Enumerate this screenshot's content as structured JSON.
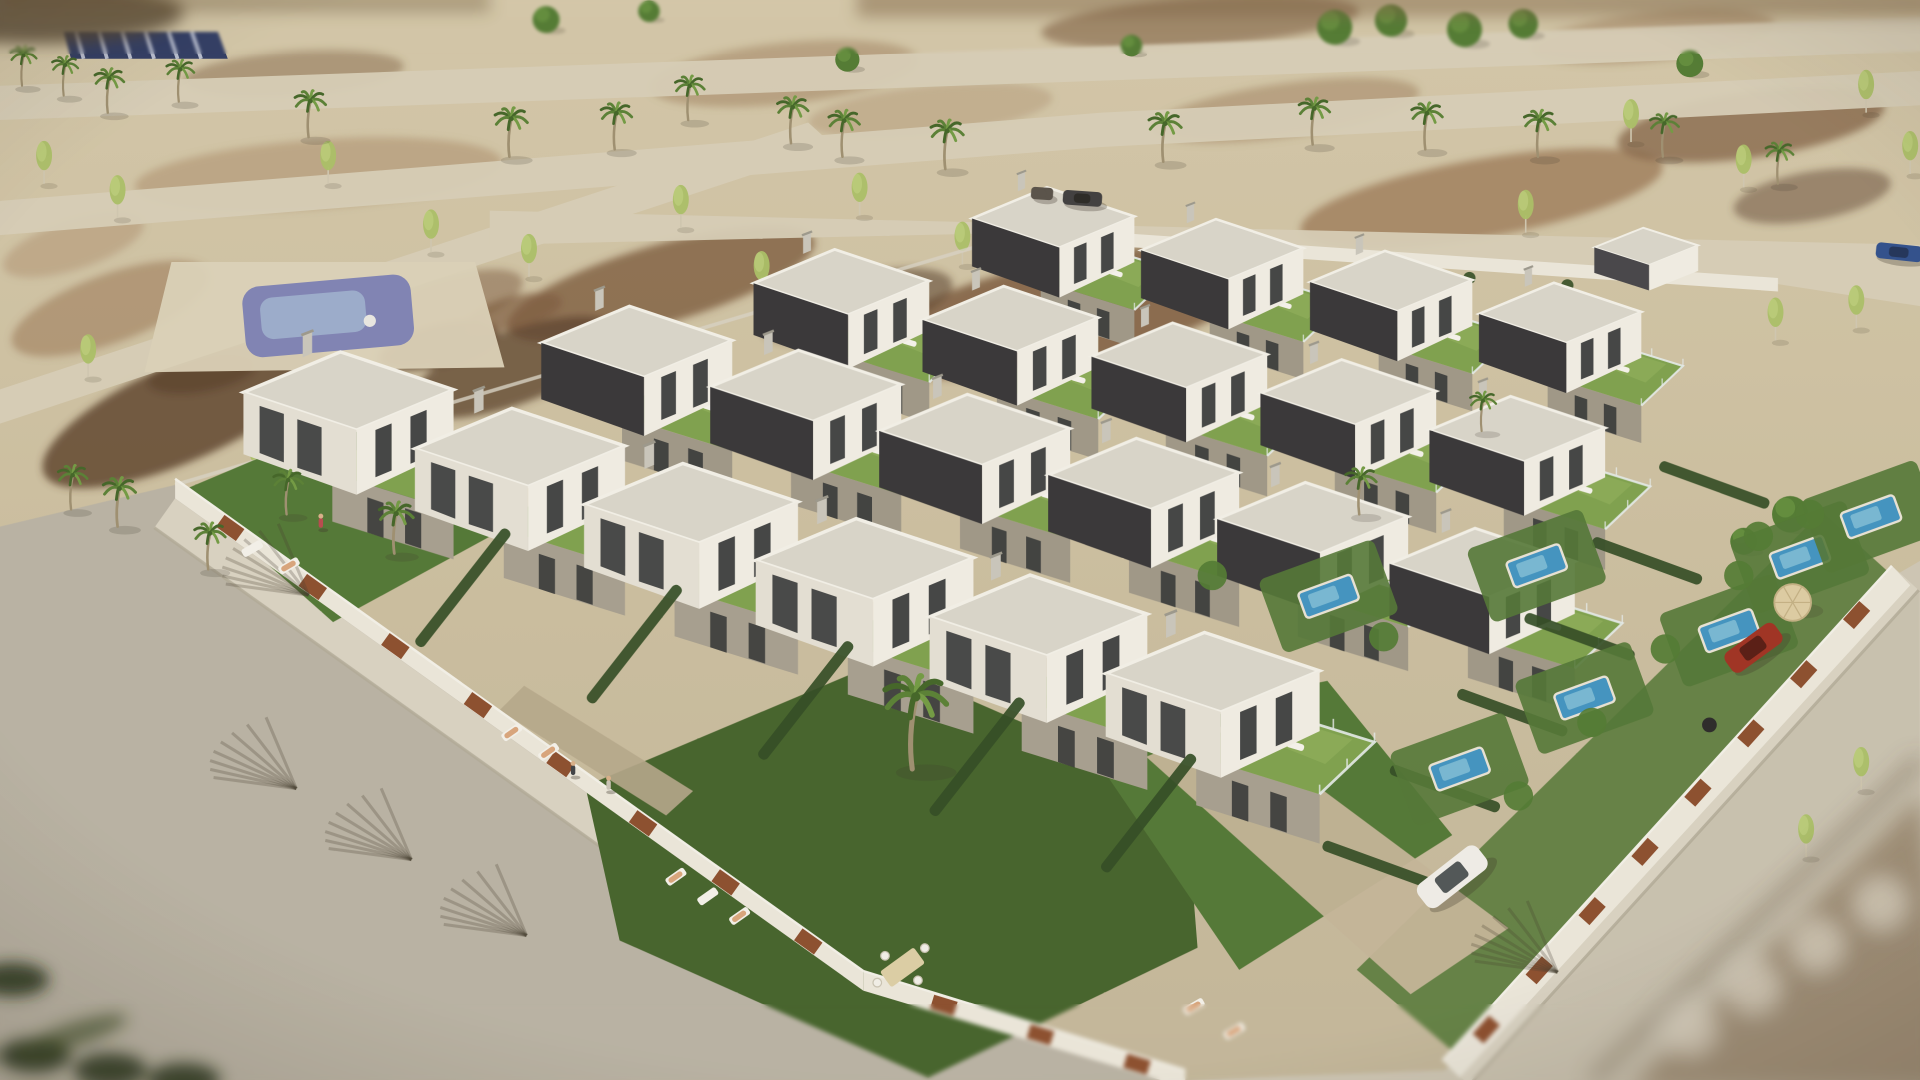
{
  "scene": {
    "name": "aerial-3d-render-modern-villa-development",
    "width": 1568,
    "height": 882
  },
  "palette": {
    "sandTop": "#d3c8ac",
    "sandMid": "#cbbfa3",
    "sandBot": "#c2b79d",
    "road": "#d6cfbb",
    "streetSW": "#b8b3a7",
    "streetSE": "#cdc7b8",
    "sidewalk": "#d8d3c6",
    "curb": "#b0aa9a",
    "dirt1": "#9b7b5b",
    "dirt2": "#7a5a40",
    "dirt3": "#5c4330",
    "dirt4": "#b2987a",
    "wall": "#ebe8df",
    "wallShade": "#d8d4c8",
    "rust": "#8a4c2e",
    "roofLight": "#d8d6ce",
    "roofFascia": "#f3f2ec",
    "darkWall": "#333338",
    "darkWall2": "#43434a",
    "white1": "#f1efe8",
    "white2": "#e4e1d8",
    "stone": "#a59f92",
    "window": "#2b2f33",
    "terrace": "#7ca14f",
    "terraceHi": "#8fb35e",
    "lawn": "#4f7636",
    "lawnDark": "#41612c",
    "hedge": "#2e4a24",
    "glass": "#e6edef",
    "poolWater": "#3e93c4",
    "poolLight": "#82c2dc",
    "parkPool": "#7d82b8",
    "parkPoolHi": "#a3bad8",
    "palmDark": "#3f6428",
    "palmMid": "#567f35",
    "palmLight": "#6f9a44",
    "trunk": "#9c8f72",
    "birch": "#a9c068",
    "birchHi": "#c6d889",
    "treeRound": "#4e7a33",
    "treeRoundHi": "#639140",
    "navy": "#2c3a66",
    "navyStripe": "#cfd6e8",
    "shadow": "#3a342a",
    "paving": "#c3b59b",
    "stonePath": "#b4a78d"
  },
  "terrain_patches": [
    [
      260,
      142,
      300,
      56,
      -4,
      "dirt4",
      0.7
    ],
    [
      540,
      232,
      260,
      64,
      -16,
      "dirt2",
      0.8
    ],
    [
      870,
      255,
      330,
      86,
      -12,
      "dirt2",
      0.85
    ],
    [
      1210,
      162,
      300,
      64,
      -10,
      "dirt1",
      0.8
    ],
    [
      1430,
      102,
      220,
      54,
      -8,
      "dirt2",
      0.7
    ],
    [
      90,
      252,
      170,
      56,
      -20,
      "dirt1",
      0.6
    ],
    [
      150,
      336,
      250,
      80,
      -24,
      "dirt3",
      0.85
    ],
    [
      420,
      300,
      180,
      60,
      -20,
      "dirt3",
      0.8
    ],
    [
      640,
      60,
      220,
      50,
      -6,
      "dirt1",
      0.5
    ],
    [
      980,
      18,
      260,
      40,
      -4,
      "dirt2",
      0.6
    ],
    [
      1350,
      30,
      200,
      40,
      -6,
      "dirt1",
      0.5
    ],
    [
      60,
      200,
      120,
      40,
      -18,
      "dirt4",
      0.6
    ],
    [
      360,
      250,
      140,
      44,
      -18,
      "dirt2",
      0.5
    ],
    [
      700,
      250,
      160,
      50,
      -14,
      "dirt3",
      0.6
    ],
    [
      1480,
      160,
      130,
      40,
      -10,
      "dirt3",
      0.5
    ],
    [
      240,
      60,
      180,
      36,
      -4,
      "dirt2",
      0.45
    ],
    [
      760,
      90,
      200,
      40,
      -6,
      "dirt4",
      0.5
    ],
    [
      1050,
      90,
      220,
      44,
      -8,
      "dirt1",
      0.5
    ],
    [
      165,
      305,
      90,
      30,
      -10,
      "dirt3",
      0.9
    ],
    [
      358,
      282,
      100,
      34,
      -14,
      "dirt3",
      0.85
    ],
    [
      420,
      255,
      80,
      26,
      -14,
      "dirt2",
      0.7
    ]
  ],
  "roads": [
    {
      "pts": [
        [
          0,
          70
        ],
        [
          1568,
          14
        ],
        [
          1568,
          42
        ],
        [
          0,
          98
        ]
      ],
      "fill": "road"
    },
    {
      "pts": [
        [
          0,
          164
        ],
        [
          900,
          92
        ],
        [
          1568,
          58
        ],
        [
          1568,
          86
        ],
        [
          900,
          120
        ],
        [
          0,
          192
        ]
      ],
      "fill": "road"
    },
    {
      "pts": [
        [
          400,
          172
        ],
        [
          1568,
          200
        ],
        [
          1568,
          250
        ],
        [
          1452,
          232
        ],
        [
          838,
          190
        ],
        [
          400,
          200
        ]
      ],
      "fill": "road"
    },
    {
      "pts": [
        [
          0,
          318
        ],
        [
          660,
          100
        ],
        [
          682,
          120
        ],
        [
          0,
          346
        ]
      ],
      "fill": "road"
    }
  ],
  "park": {
    "plaza": [
      [
        140,
        214
      ],
      [
        388,
        214
      ],
      [
        412,
        300
      ],
      [
        118,
        304
      ]
    ],
    "pool": {
      "x": 268,
      "y": 258,
      "w": 138,
      "h": 58,
      "rot": -5
    },
    "dot": [
      302,
      262
    ]
  },
  "crosswalk": {
    "pts": [
      [
        52,
        26
      ],
      [
        178,
        26
      ],
      [
        186,
        48
      ],
      [
        58,
        48
      ]
    ],
    "stripes": 6
  },
  "streets": {
    "sw": [
      [
        143,
        396
      ],
      [
        705,
        798
      ],
      [
        968,
        882
      ],
      [
        0,
        882
      ],
      [
        0,
        430
      ]
    ],
    "sw_sidewalk": [
      [
        143,
        407
      ],
      [
        705,
        809
      ],
      [
        688,
        833
      ],
      [
        126,
        431
      ]
    ],
    "se": [
      [
        1551,
        468
      ],
      [
        1180,
        874
      ],
      [
        968,
        882
      ],
      [
        1568,
        882
      ],
      [
        1568,
        458
      ]
    ],
    "se_sidewalk": [
      [
        1545,
        462
      ],
      [
        1178,
        866
      ],
      [
        1200,
        886
      ],
      [
        1567,
        482
      ]
    ],
    "se_road_overlay": [
      [
        1567,
        484
      ],
      [
        1202,
        882
      ],
      [
        1568,
        882
      ]
    ]
  },
  "walls": {
    "sw": [
      [
        143,
        391
      ],
      [
        705,
        793
      ],
      [
        705,
        809
      ],
      [
        143,
        407
      ]
    ],
    "s": [
      [
        705,
        793
      ],
      [
        968,
        874
      ],
      [
        968,
        888
      ],
      [
        705,
        809
      ]
    ],
    "se": [
      [
        1545,
        462
      ],
      [
        1178,
        866
      ],
      [
        1192,
        880
      ],
      [
        1560,
        478
      ]
    ],
    "n": [
      [
        838,
        185
      ],
      [
        1452,
        227
      ],
      [
        1452,
        238
      ],
      [
        838,
        196
      ]
    ],
    "nw_line": [
      [
        143,
        396
      ],
      [
        836,
        190
      ]
    ],
    "rust_sw_t": [
      0.08,
      0.2,
      0.32,
      0.44,
      0.56,
      0.68,
      0.8,
      0.92
    ],
    "rust_s_t": [
      0.25,
      0.55,
      0.85
    ],
    "rust_se_t": [
      0.08,
      0.2,
      0.32,
      0.44,
      0.56,
      0.68,
      0.8,
      0.92
    ]
  },
  "lawns": [
    {
      "pts": [
        [
          150,
          400
        ],
        [
          302,
          336
        ],
        [
          426,
          424
        ],
        [
          272,
          508
        ]
      ],
      "fill": "lawn"
    },
    {
      "pts": [
        [
          478,
          642
        ],
        [
          720,
          540
        ],
        [
          968,
          648
        ],
        [
          978,
          774
        ],
        [
          758,
          880
        ],
        [
          506,
          768
        ]
      ],
      "fill": "lawnDark"
    },
    {
      "pts": [
        [
          880,
          598
        ],
        [
          1084,
          556
        ],
        [
          1186,
          682
        ],
        [
          1012,
          792
        ]
      ],
      "fill": "lawn"
    },
    {
      "pts": [
        [
          1552,
          476
        ],
        [
          1186,
          858
        ],
        [
          1108,
          792
        ],
        [
          1488,
          418
        ]
      ],
      "fill": "lawn",
      "op": 0.85
    }
  ],
  "driveway": [
    [
      936,
      618
    ],
    [
      1006,
      590
    ],
    [
      1232,
      758
    ],
    [
      1152,
      812
    ]
  ],
  "stone_path": [
    [
      428,
      560
    ],
    [
      566,
      646
    ],
    [
      544,
      666
    ],
    [
      408,
      580
    ]
  ],
  "hedges": [
    {
      "x": 1290,
      "y": 520,
      "rot": 20,
      "len": 95
    },
    {
      "x": 1235,
      "y": 582,
      "rot": 20,
      "len": 95
    },
    {
      "x": 1180,
      "y": 644,
      "rot": 20,
      "len": 95
    },
    {
      "x": 1125,
      "y": 706,
      "rot": 20,
      "len": 95
    },
    {
      "x": 1345,
      "y": 458,
      "rot": 20,
      "len": 95
    },
    {
      "x": 1400,
      "y": 396,
      "rot": 20,
      "len": 95
    },
    {
      "x": 378,
      "y": 480,
      "rot": -52,
      "len": 120
    },
    {
      "x": 518,
      "y": 526,
      "rot": -52,
      "len": 120
    },
    {
      "x": 658,
      "y": 572,
      "rot": -52,
      "len": 120
    },
    {
      "x": 798,
      "y": 618,
      "rot": -52,
      "len": 120
    },
    {
      "x": 938,
      "y": 664,
      "rot": -52,
      "len": 120
    }
  ],
  "villas": [
    [
      872,
      192,
      0.85,
      "back"
    ],
    [
      1010,
      218,
      0.85,
      "back"
    ],
    [
      1148,
      244,
      0.85,
      "back"
    ],
    [
      1286,
      270,
      0.85,
      "back"
    ],
    [
      1350,
      210,
      0.8,
      "low"
    ],
    [
      700,
      246,
      0.92,
      "back"
    ],
    [
      838,
      276,
      0.92,
      "back"
    ],
    [
      976,
      306,
      0.92,
      "back"
    ],
    [
      1114,
      336,
      0.92,
      "back"
    ],
    [
      1252,
      366,
      0.92,
      "back"
    ],
    [
      534,
      296,
      1.0,
      "back"
    ],
    [
      672,
      332,
      1.0,
      "back"
    ],
    [
      810,
      368,
      1.0,
      "back"
    ],
    [
      948,
      404,
      1.0,
      "back"
    ],
    [
      1086,
      440,
      1.0,
      "back"
    ],
    [
      1224,
      476,
      0.97,
      "back"
    ],
    [
      300,
      338,
      1.1,
      "front"
    ],
    [
      440,
      384,
      1.1,
      "front"
    ],
    [
      580,
      430,
      1.12,
      "front"
    ],
    [
      722,
      476,
      1.14,
      "front"
    ],
    [
      864,
      522,
      1.14,
      "front"
    ],
    [
      1006,
      568,
      1.12,
      "front"
    ]
  ],
  "pools": [
    [
      1085,
      487
    ],
    [
      1192,
      628
    ],
    [
      1294,
      570
    ],
    [
      1255,
      462
    ],
    [
      1412,
      515
    ],
    [
      1470,
      455
    ],
    [
      1528,
      422
    ]
  ],
  "garden_trees": [
    [
      1420,
      470
    ],
    [
      1360,
      530
    ],
    [
      1300,
      590
    ],
    [
      1240,
      650
    ],
    [
      990,
      470
    ],
    [
      1130,
      520
    ],
    [
      1436,
      438
    ],
    [
      1478,
      420
    ]
  ],
  "palms": [
    [
      18,
      70,
      0.8
    ],
    [
      52,
      78,
      0.8
    ],
    [
      88,
      92,
      0.9
    ],
    [
      146,
      83,
      0.85
    ],
    [
      252,
      112,
      0.95
    ],
    [
      416,
      128,
      1
    ],
    [
      502,
      122,
      0.95
    ],
    [
      562,
      98,
      0.9
    ],
    [
      646,
      117,
      0.95
    ],
    [
      688,
      128,
      0.95
    ],
    [
      772,
      138,
      1
    ],
    [
      950,
      132,
      1
    ],
    [
      1072,
      118,
      0.95
    ],
    [
      1164,
      122,
      0.95
    ],
    [
      1256,
      128,
      0.95
    ],
    [
      1358,
      128,
      0.88
    ],
    [
      1452,
      150,
      0.85
    ],
    [
      906,
      216,
      0.8
    ]
  ],
  "palms_fg": [
    [
      96,
      430,
      1.0
    ],
    [
      58,
      416,
      0.9
    ],
    [
      170,
      465,
      0.95
    ],
    [
      322,
      452,
      1.05
    ],
    [
      234,
      420,
      0.9
    ],
    [
      1110,
      420,
      0.95
    ],
    [
      1210,
      352,
      0.8
    ],
    [
      745,
      628,
      1.9
    ]
  ],
  "birches": [
    [
      36,
      150
    ],
    [
      96,
      178
    ],
    [
      72,
      308
    ],
    [
      210,
      390
    ],
    [
      268,
      150
    ],
    [
      352,
      206
    ],
    [
      432,
      226
    ],
    [
      496,
      300
    ],
    [
      556,
      186
    ],
    [
      622,
      240
    ],
    [
      702,
      176
    ],
    [
      786,
      216
    ],
    [
      852,
      282
    ],
    [
      856,
      430
    ],
    [
      1002,
      292
    ],
    [
      1012,
      372
    ],
    [
      1158,
      290
    ],
    [
      1246,
      190
    ],
    [
      1332,
      116
    ],
    [
      1424,
      153
    ],
    [
      1450,
      278
    ],
    [
      1516,
      268
    ],
    [
      1524,
      92
    ],
    [
      1560,
      142
    ],
    [
      934,
      468
    ],
    [
      1475,
      700
    ],
    [
      1520,
      645
    ]
  ],
  "round_trees": [
    [
      446,
      22,
      1
    ],
    [
      692,
      54,
      0.9
    ],
    [
      1090,
      30,
      1.3
    ],
    [
      1136,
      24,
      1.2
    ],
    [
      1196,
      32,
      1.3
    ],
    [
      1244,
      26,
      1.1
    ],
    [
      1380,
      58,
      1
    ],
    [
      924,
      42,
      0.8
    ],
    [
      1462,
      428,
      1.35
    ],
    [
      1424,
      448,
      1
    ],
    [
      530,
      14,
      0.8
    ]
  ],
  "north_bushes": [
    [
      880,
      202
    ],
    [
      960,
      209
    ],
    [
      1040,
      215
    ],
    [
      1120,
      221
    ],
    [
      1200,
      227
    ],
    [
      1280,
      233
    ]
  ],
  "cars": [
    {
      "name": "white-sedan",
      "x": 1186,
      "y": 716,
      "rot": -38,
      "len": 62,
      "wid": 24,
      "body": "#f0efec",
      "top": "#3a4348"
    },
    {
      "name": "red-car",
      "x": 1432,
      "y": 529,
      "rot": -36,
      "len": 50,
      "wid": 20,
      "body": "#9e2f22",
      "top": "#4c1713"
    },
    {
      "name": "blue-car",
      "x": 1551,
      "y": 206,
      "rot": 6,
      "len": 38,
      "wid": 13,
      "body": "#2c4d8f",
      "top": "#1c2f55"
    },
    {
      "name": "dark-car",
      "x": 884,
      "y": 162,
      "rot": 4,
      "len": 32,
      "wid": 12,
      "body": "#3c3c40",
      "top": "#222222"
    },
    {
      "name": "trailer",
      "x": 851,
      "y": 158,
      "rot": 4,
      "len": 18,
      "wid": 10,
      "body": "#55504a",
      "top": "#55504a"
    }
  ],
  "people": [
    [
      468,
      634,
      "#3a3f46"
    ],
    [
      497,
      646,
      "#c9c4ba"
    ],
    [
      262,
      432,
      "#b8474f"
    ]
  ],
  "loungers": [
    {
      "x": 206,
      "y": 448,
      "rot": -30,
      "person": false
    },
    {
      "x": 236,
      "y": 462,
      "rot": -30,
      "person": true
    },
    {
      "x": 418,
      "y": 598,
      "rot": -35,
      "person": true
    },
    {
      "x": 448,
      "y": 614,
      "rot": -35,
      "person": true
    },
    {
      "x": 552,
      "y": 716,
      "rot": -35,
      "person": true
    },
    {
      "x": 578,
      "y": 732,
      "rot": -35,
      "person": false
    },
    {
      "x": 604,
      "y": 748,
      "rot": -35,
      "person": true
    },
    {
      "x": 975,
      "y": 822,
      "rot": -30,
      "person": true
    },
    {
      "x": 1008,
      "y": 842,
      "rot": -30,
      "person": true
    }
  ],
  "table_set": {
    "x": 737,
    "y": 790,
    "rot": -36
  },
  "umbrella": {
    "x": 1464,
    "y": 492,
    "r": 15
  },
  "pouf": {
    "x": 1396,
    "y": 592,
    "r": 6
  },
  "shadow_fans": [
    [
      336,
      702
    ],
    [
      430,
      764
    ],
    [
      242,
      644
    ],
    [
      252,
      486
    ],
    [
      1272,
      794
    ]
  ],
  "blur_notes": {
    "bottom_right": "out-of-focus pavement corner",
    "bottom_left": "out-of-focus palm fronds",
    "top_edges": "distant blurred field"
  }
}
